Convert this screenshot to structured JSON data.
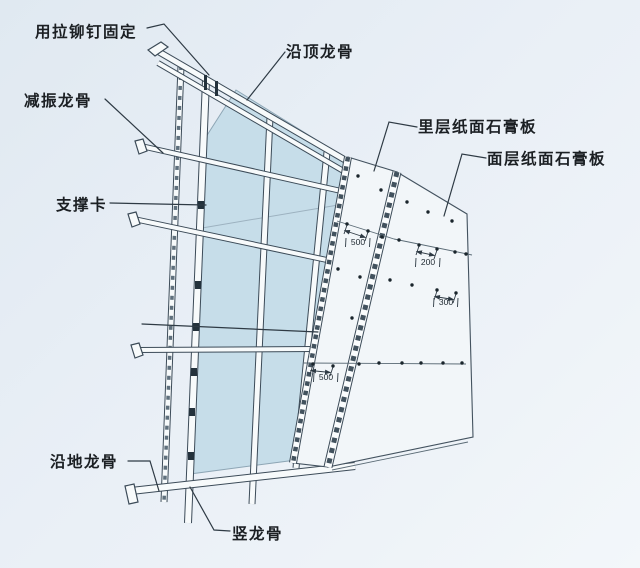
{
  "drawing": {
    "labels": [
      {
        "id": "rivet-fix",
        "text": "用拉铆钉固定",
        "x": 35,
        "y": 37
      },
      {
        "id": "top-track",
        "text": "沿顶龙骨",
        "x": 286,
        "y": 57
      },
      {
        "id": "resilient-channel",
        "text": "减振龙骨",
        "x": 24,
        "y": 106
      },
      {
        "id": "support-clip",
        "text": "支撑卡",
        "x": 56,
        "y": 210
      },
      {
        "id": "inner-gypsum-board",
        "text": "里层纸面石膏板",
        "x": 418,
        "y": 132
      },
      {
        "id": "face-gypsum-board",
        "text": "面层纸面石膏板",
        "x": 487,
        "y": 164
      },
      {
        "id": "floor-track",
        "text": "沿地龙骨",
        "x": 50,
        "y": 467
      },
      {
        "id": "vertical-stud",
        "text": "竖龙骨",
        "x": 232,
        "y": 539
      }
    ],
    "leaders": [
      {
        "id": "rivet-fix",
        "points": "147,28 164,24 209,75"
      },
      {
        "id": "top-track",
        "points": "285,52 247,100"
      },
      {
        "id": "resilient-channel",
        "points": "105,99 163,153"
      },
      {
        "id": "support-clip",
        "points": "110,203 206,205"
      },
      {
        "id": "inner-gypsum-board",
        "points": "417,127 389,122 374,171"
      },
      {
        "id": "face-gypsum-board",
        "points": "486,158 462,154 444,216"
      },
      {
        "id": "pointer-line",
        "points": "142,324 318,332"
      },
      {
        "id": "floor-track",
        "points": "128,461 150,461 159,491"
      },
      {
        "id": "vertical-stud",
        "points": "230,531 214,530 190,487"
      }
    ],
    "dimensions": [
      {
        "value": "500",
        "from": [
          347,
          224
        ],
        "to": [
          368,
          231
        ],
        "tx": 358,
        "ty": 245
      },
      {
        "value": "200",
        "from": [
          419,
          245
        ],
        "to": [
          437,
          249
        ],
        "tx": 428,
        "ty": 265
      },
      {
        "value": "300",
        "from": [
          437,
          290
        ],
        "to": [
          456,
          293
        ],
        "tx": 446,
        "ty": 305
      },
      {
        "value": "500",
        "from": [
          313,
          364
        ],
        "to": [
          333,
          366
        ],
        "tx": 326,
        "ty": 380
      }
    ],
    "screw_dots": {
      "inner_board": [
        [
          358,
          176
        ],
        [
          347,
          224
        ],
        [
          368,
          231
        ],
        [
          338,
          269
        ],
        [
          360,
          277
        ],
        [
          352,
          318
        ],
        [
          313,
          364
        ],
        [
          333,
          366
        ]
      ],
      "face_board": [
        [
          381,
          190
        ],
        [
          407,
          202
        ],
        [
          428,
          212
        ],
        [
          452,
          221
        ],
        [
          382,
          237
        ],
        [
          399,
          240
        ],
        [
          419,
          245
        ],
        [
          437,
          249
        ],
        [
          455,
          252
        ],
        [
          466,
          254
        ],
        [
          390,
          280
        ],
        [
          412,
          285
        ],
        [
          437,
          290
        ],
        [
          456,
          293
        ],
        [
          359,
          364
        ],
        [
          379,
          363
        ],
        [
          402,
          363
        ],
        [
          421,
          363
        ],
        [
          443,
          363
        ],
        [
          462,
          363
        ]
      ]
    },
    "colors": {
      "background": "#e9eff6",
      "panel_blue": "#c6dde9",
      "line": "#3c4b58",
      "ink": "#1b1f23",
      "board": "#f2f6f9"
    }
  }
}
